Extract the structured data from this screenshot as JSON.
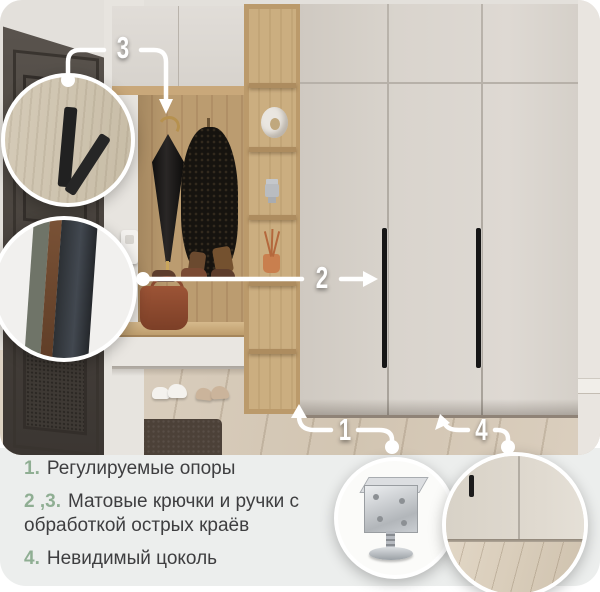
{
  "callouts": {
    "c1": {
      "label": "1"
    },
    "c2": {
      "label": "2"
    },
    "c3": {
      "label": "3"
    },
    "c4": {
      "label": "4"
    }
  },
  "legend": {
    "items": [
      {
        "num": "1.",
        "text": "Регулируемые опоры"
      },
      {
        "num": "2 ,3.",
        "text": "Матовые крючки и ручки с обработкой острых краёв"
      },
      {
        "num": "4.",
        "text": "Невидимый цоколь"
      }
    ]
  },
  "insets": {
    "hook_detail": "matte-black-hook",
    "edge_detail": "handle-edge-profile",
    "foot_detail": "adjustable-support-foot",
    "plinth_detail": "invisible-plinth-base"
  },
  "colors": {
    "accent_green": "#8fae93",
    "panel_bg": "#eceeed",
    "callout_line": "#ffffff",
    "text_dark": "#3e3e40"
  }
}
